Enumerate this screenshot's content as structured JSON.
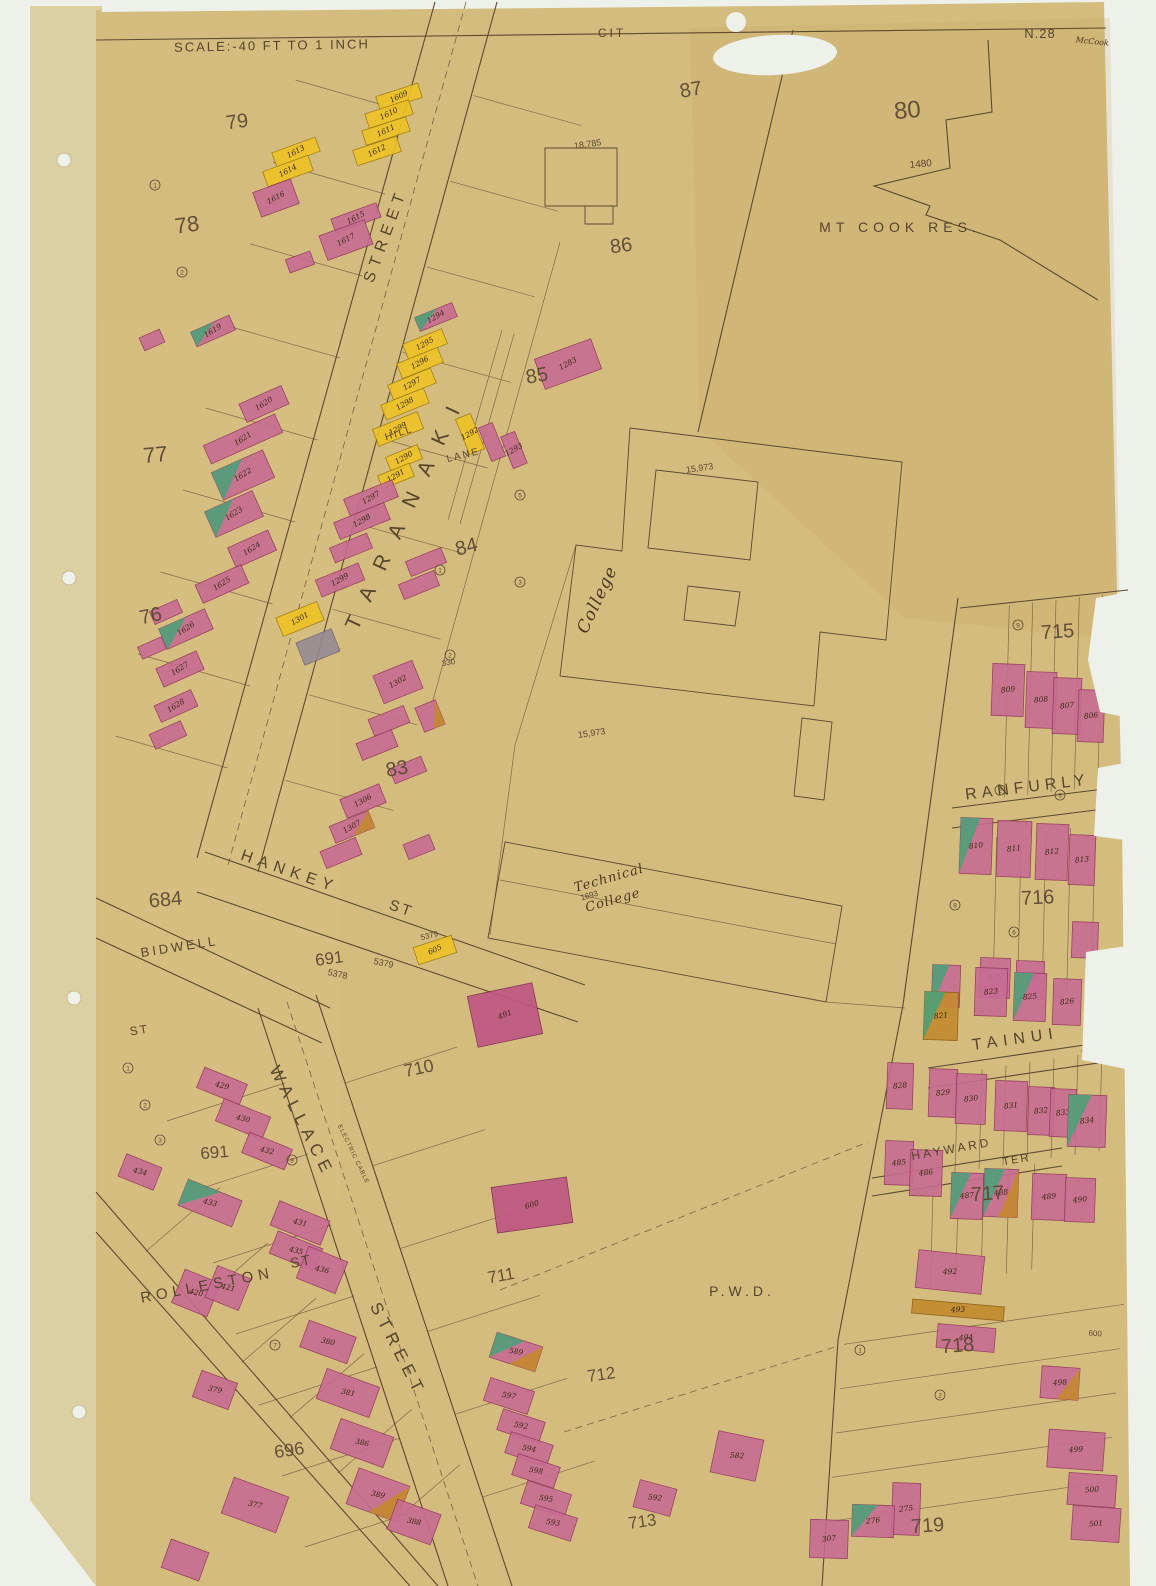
{
  "sheet": {
    "scale_label": "SCALE:-40 FT TO 1 INCH",
    "city_label": "CIT",
    "sheet_number": "N.28",
    "corner_note": "McCook"
  },
  "colors": {
    "scan": "#eef0ea",
    "binding": "#dccfa2",
    "paper": "#d4bc7e",
    "ink": "#5d4a31",
    "text": "#57442c",
    "pink": "#c76d92",
    "pink_deep": "#bf5584",
    "yellow": "#eec226",
    "orange": "#c38a2e",
    "green": "#4f9e78",
    "grey": "#958a94"
  },
  "blocks": [
    {
      "t": "79",
      "x": 238,
      "y": 128,
      "s": 20,
      "r": -8
    },
    {
      "t": "78",
      "x": 188,
      "y": 232,
      "s": 22,
      "r": -8
    },
    {
      "t": "77",
      "x": 156,
      "y": 462,
      "s": 22,
      "r": -5
    },
    {
      "t": "76",
      "x": 152,
      "y": 622,
      "s": 20,
      "r": -12
    },
    {
      "t": "80",
      "x": 908,
      "y": 118,
      "s": 24,
      "r": -5
    },
    {
      "t": "87",
      "x": 692,
      "y": 96,
      "s": 20,
      "r": -10
    },
    {
      "t": "86",
      "x": 622,
      "y": 252,
      "s": 20,
      "r": -8
    },
    {
      "t": "85",
      "x": 538,
      "y": 382,
      "s": 20,
      "r": -10
    },
    {
      "t": "84",
      "x": 468,
      "y": 553,
      "s": 20,
      "r": -15
    },
    {
      "t": "83",
      "x": 398,
      "y": 775,
      "s": 20,
      "r": -10
    },
    {
      "t": "684",
      "x": 166,
      "y": 906,
      "s": 20,
      "r": -5
    },
    {
      "t": "691",
      "x": 330,
      "y": 964,
      "s": 17,
      "r": -8
    },
    {
      "t": "691",
      "x": 215,
      "y": 1158,
      "s": 17,
      "r": -5
    },
    {
      "t": "696",
      "x": 290,
      "y": 1456,
      "s": 18,
      "r": -8
    },
    {
      "t": "710",
      "x": 420,
      "y": 1074,
      "s": 18,
      "r": -12
    },
    {
      "t": "711",
      "x": 502,
      "y": 1281,
      "s": 17,
      "r": -10
    },
    {
      "t": "712",
      "x": 602,
      "y": 1380,
      "s": 17,
      "r": -8
    },
    {
      "t": "713",
      "x": 643,
      "y": 1527,
      "s": 17,
      "r": -8
    },
    {
      "t": "715",
      "x": 1058,
      "y": 638,
      "s": 20,
      "r": -4
    },
    {
      "t": "716",
      "x": 1038,
      "y": 904,
      "s": 20,
      "r": -3
    },
    {
      "t": "717",
      "x": 988,
      "y": 1200,
      "s": 20,
      "r": -4
    },
    {
      "t": "718",
      "x": 958,
      "y": 1352,
      "s": 20,
      "r": -4
    },
    {
      "t": "719",
      "x": 928,
      "y": 1532,
      "s": 20,
      "r": -4
    }
  ],
  "streets": [
    {
      "id": "taranaki",
      "t": "TARANAKI",
      "x": 413,
      "y": 512,
      "r": -65,
      "s": 21,
      "sp": 20
    },
    {
      "id": "taranaki-street",
      "t": "STREET",
      "x": 390,
      "y": 237,
      "r": -70,
      "s": 16,
      "sp": 6
    },
    {
      "id": "hankey",
      "t": "HANKEY",
      "x": 288,
      "y": 876,
      "r": 19,
      "s": 16,
      "sp": 6
    },
    {
      "id": "hankey-st",
      "t": "ST",
      "x": 400,
      "y": 913,
      "r": 19,
      "s": 15,
      "sp": 3
    },
    {
      "id": "bidwell",
      "t": "BIDWELL",
      "x": 180,
      "y": 951,
      "r": -9,
      "s": 13,
      "sp": 3
    },
    {
      "id": "bidwell-st",
      "t": "ST",
      "x": 140,
      "y": 1034,
      "r": -9,
      "s": 12,
      "sp": 2
    },
    {
      "id": "wallace",
      "t": "WALLACE",
      "x": 297,
      "y": 1124,
      "r": 63,
      "s": 17,
      "sp": 6
    },
    {
      "id": "wallace-street",
      "t": "STREET",
      "x": 393,
      "y": 1352,
      "r": 63,
      "s": 17,
      "sp": 6
    },
    {
      "id": "rolleston",
      "t": "ROLLESTON",
      "x": 208,
      "y": 1290,
      "r": -11,
      "s": 15,
      "sp": 5
    },
    {
      "id": "rolleston-st",
      "t": "ST",
      "x": 302,
      "y": 1266,
      "r": -11,
      "s": 14,
      "sp": 2
    },
    {
      "id": "ranfurly",
      "t": "RANFURLY",
      "x": 1028,
      "y": 792,
      "r": -7,
      "s": 16,
      "sp": 5
    },
    {
      "id": "ranfurly-tce",
      "t": "TCE",
      "x": 1110,
      "y": 798,
      "r": -7,
      "s": 11,
      "sp": 1
    },
    {
      "id": "tainui",
      "t": "TAINUI",
      "x": 1016,
      "y": 1044,
      "r": -8,
      "s": 16,
      "sp": 6
    },
    {
      "id": "tainui-ter",
      "t": "TER",
      "x": 1102,
      "y": 1058,
      "r": -8,
      "s": 15,
      "sp": 3
    },
    {
      "id": "hayward",
      "t": "HAYWARD",
      "x": 952,
      "y": 1153,
      "r": -10,
      "s": 12,
      "sp": 3
    },
    {
      "id": "hayward-ter",
      "t": "TER",
      "x": 1017,
      "y": 1163,
      "r": -10,
      "s": 11,
      "sp": 2
    },
    {
      "id": "hill",
      "t": "HILL",
      "x": 400,
      "y": 436,
      "r": -18,
      "s": 10,
      "sp": 2
    },
    {
      "id": "lane",
      "t": "LANE",
      "x": 464,
      "y": 458,
      "r": -14,
      "s": 10,
      "sp": 2
    },
    {
      "id": "electric-cable",
      "t": "ELECTRIC CABLE",
      "x": 352,
      "y": 1155,
      "r": 64,
      "s": 6,
      "sp": 1
    }
  ],
  "landmarks": [
    {
      "id": "mt-cook-res",
      "t": "MT COOK RES.",
      "x": 900,
      "y": 232,
      "r": 0,
      "s": 14,
      "sp": 5,
      "style": "print"
    },
    {
      "id": "college",
      "t": "College",
      "x": 602,
      "y": 602,
      "r": -65,
      "s": 17,
      "sp": 1,
      "style": "script"
    },
    {
      "id": "technical",
      "t": "Technical",
      "x": 610,
      "y": 882,
      "r": -16,
      "s": 13,
      "sp": 1,
      "style": "script"
    },
    {
      "id": "technical-college",
      "t": "College",
      "x": 614,
      "y": 904,
      "r": -16,
      "s": 13,
      "sp": 1,
      "style": "script"
    },
    {
      "id": "pwd",
      "t": "P.W.D.",
      "x": 742,
      "y": 1296,
      "r": 0,
      "s": 14,
      "sp": 4,
      "style": "print"
    }
  ],
  "refs": [
    {
      "t": "1480",
      "x": 921,
      "y": 167,
      "r": -5,
      "s": 10
    },
    {
      "t": "18,785",
      "x": 588,
      "y": 147,
      "r": -8,
      "s": 9
    },
    {
      "t": "15,973",
      "x": 700,
      "y": 471,
      "r": -8,
      "s": 9
    },
    {
      "t": "15,973",
      "x": 592,
      "y": 736,
      "r": -8,
      "s": 9
    },
    {
      "t": "5379",
      "x": 383,
      "y": 966,
      "r": 12,
      "s": 9
    },
    {
      "t": "5378",
      "x": 337,
      "y": 977,
      "r": 12,
      "s": 9
    },
    {
      "t": "5379",
      "x": 430,
      "y": 938,
      "r": -15,
      "s": 8
    },
    {
      "t": "330",
      "x": 449,
      "y": 665,
      "r": -10,
      "s": 8
    },
    {
      "t": "1693",
      "x": 590,
      "y": 898,
      "r": -16,
      "s": 8
    },
    {
      "t": "600",
      "x": 1095,
      "y": 1336,
      "r": 4,
      "s": 8
    }
  ],
  "buildings_format": "[cx, cy, w, h, rotation_deg, color_code(P pink, D deep-pink, Y yellow, O orange, N grey; +G green patch, +O orange patch), label]",
  "buildings": [
    [
      399,
      97,
      44,
      15,
      -18,
      "Y",
      "1609"
    ],
    [
      389,
      114,
      46,
      15,
      -18,
      "Y",
      "1610"
    ],
    [
      386,
      131,
      46,
      15,
      -18,
      "Y",
      "1611"
    ],
    [
      377,
      151,
      46,
      16,
      -18,
      "Y",
      "1612"
    ],
    [
      296,
      152,
      46,
      15,
      -20,
      "Y",
      "1613"
    ],
    [
      288,
      171,
      48,
      16,
      -20,
      "Y",
      "1614"
    ],
    [
      276,
      198,
      40,
      26,
      -20,
      "P",
      "1616"
    ],
    [
      356,
      218,
      48,
      15,
      -20,
      "P",
      "1615"
    ],
    [
      346,
      240,
      48,
      26,
      -20,
      "P",
      "1617"
    ],
    [
      300,
      262,
      26,
      14,
      -20,
      "P",
      ""
    ],
    [
      213,
      331,
      42,
      16,
      -24,
      "PG",
      "1619"
    ],
    [
      152,
      340,
      22,
      14,
      -24,
      "P",
      ""
    ],
    [
      264,
      404,
      46,
      20,
      -24,
      "P",
      "1620"
    ],
    [
      243,
      439,
      78,
      20,
      -24,
      "P",
      "1621"
    ],
    [
      243,
      475,
      56,
      30,
      -24,
      "PG",
      "1622"
    ],
    [
      234,
      514,
      52,
      28,
      -24,
      "PG",
      "1623"
    ],
    [
      252,
      549,
      44,
      22,
      -24,
      "P",
      "1624"
    ],
    [
      222,
      584,
      50,
      20,
      -24,
      "P",
      "1625"
    ],
    [
      186,
      629,
      50,
      22,
      -24,
      "PG",
      "1626"
    ],
    [
      180,
      669,
      44,
      20,
      -24,
      "P",
      "1627"
    ],
    [
      166,
      612,
      30,
      14,
      -24,
      "P",
      ""
    ],
    [
      152,
      648,
      26,
      13,
      -24,
      "P",
      ""
    ],
    [
      176,
      706,
      40,
      18,
      -24,
      "P",
      "1628"
    ],
    [
      168,
      735,
      34,
      16,
      -24,
      "P",
      ""
    ],
    [
      436,
      317,
      40,
      15,
      -22,
      "PG",
      "1294"
    ],
    [
      425,
      344,
      42,
      16,
      -22,
      "Y",
      "1295"
    ],
    [
      420,
      363,
      44,
      16,
      -22,
      "Y",
      "1296"
    ],
    [
      412,
      384,
      46,
      16,
      -22,
      "Y",
      "1297"
    ],
    [
      405,
      404,
      46,
      16,
      -22,
      "Y",
      "1298"
    ],
    [
      398,
      429,
      48,
      18,
      -22,
      "Y",
      "1299"
    ],
    [
      404,
      458,
      34,
      15,
      -22,
      "Y",
      "1290"
    ],
    [
      396,
      476,
      34,
      14,
      -22,
      "Y",
      "1291"
    ],
    [
      568,
      364,
      60,
      32,
      -20,
      "P",
      "1283"
    ],
    [
      470,
      434,
      16,
      38,
      -22,
      "Y",
      "1292"
    ],
    [
      492,
      442,
      15,
      36,
      -22,
      "P",
      ""
    ],
    [
      514,
      450,
      15,
      34,
      -22,
      "P",
      "1293"
    ],
    [
      371,
      498,
      52,
      18,
      -22,
      "P",
      "1297"
    ],
    [
      362,
      521,
      54,
      18,
      -22,
      "P",
      "1298"
    ],
    [
      351,
      548,
      40,
      16,
      -22,
      "P",
      ""
    ],
    [
      340,
      580,
      46,
      18,
      -22,
      "P",
      "1299"
    ],
    [
      426,
      562,
      38,
      16,
      -22,
      "P",
      ""
    ],
    [
      419,
      585,
      38,
      16,
      -22,
      "P",
      ""
    ],
    [
      300,
      619,
      44,
      20,
      -22,
      "Y",
      "1301"
    ],
    [
      318,
      647,
      38,
      24,
      -22,
      "N",
      ""
    ],
    [
      398,
      682,
      42,
      30,
      -22,
      "P",
      "1302"
    ],
    [
      389,
      721,
      38,
      18,
      -22,
      "P",
      ""
    ],
    [
      377,
      745,
      38,
      18,
      -22,
      "P",
      ""
    ],
    [
      430,
      716,
      22,
      26,
      -22,
      "PO",
      ""
    ],
    [
      363,
      801,
      42,
      20,
      -22,
      "P",
      "1306"
    ],
    [
      352,
      827,
      42,
      18,
      -22,
      "PO",
      "1307"
    ],
    [
      341,
      853,
      38,
      18,
      -22,
      "P",
      ""
    ],
    [
      419,
      847,
      28,
      16,
      -22,
      "P",
      ""
    ],
    [
      408,
      770,
      34,
      16,
      -22,
      "P",
      ""
    ],
    [
      435,
      950,
      40,
      18,
      -18,
      "Y",
      "605"
    ],
    [
      505,
      1015,
      66,
      52,
      -12,
      "D",
      "491"
    ],
    [
      532,
      1205,
      76,
      46,
      -8,
      "D",
      "600"
    ],
    [
      222,
      1086,
      46,
      22,
      22,
      "P",
      "429"
    ],
    [
      243,
      1119,
      50,
      24,
      22,
      "P",
      "430"
    ],
    [
      267,
      1151,
      46,
      22,
      22,
      "P",
      "432"
    ],
    [
      140,
      1172,
      38,
      24,
      22,
      "P",
      "434"
    ],
    [
      210,
      1203,
      58,
      28,
      22,
      "PG",
      "433"
    ],
    [
      300,
      1223,
      54,
      26,
      22,
      "P",
      "431"
    ],
    [
      296,
      1251,
      48,
      24,
      22,
      "P",
      "435"
    ],
    [
      322,
      1270,
      42,
      34,
      22,
      "P",
      "436"
    ],
    [
      196,
      1293,
      38,
      36,
      22,
      "P",
      "420"
    ],
    [
      228,
      1288,
      36,
      34,
      22,
      "P",
      "421"
    ],
    [
      215,
      1390,
      38,
      28,
      20,
      "P",
      "379"
    ],
    [
      328,
      1342,
      50,
      28,
      20,
      "P",
      "380"
    ],
    [
      348,
      1393,
      56,
      32,
      20,
      "P",
      "381"
    ],
    [
      362,
      1443,
      56,
      32,
      20,
      "P",
      "386"
    ],
    [
      255,
      1505,
      58,
      38,
      20,
      "P",
      "377"
    ],
    [
      378,
      1495,
      54,
      38,
      20,
      "PO",
      "389"
    ],
    [
      414,
      1522,
      46,
      32,
      20,
      "P",
      "388"
    ],
    [
      185,
      1560,
      40,
      30,
      20,
      "P",
      ""
    ],
    [
      516,
      1352,
      48,
      26,
      18,
      "PGO",
      "589"
    ],
    [
      509,
      1396,
      46,
      24,
      18,
      "P",
      "597"
    ],
    [
      521,
      1426,
      44,
      22,
      18,
      "P",
      "592"
    ],
    [
      529,
      1449,
      44,
      22,
      18,
      "P",
      "594"
    ],
    [
      536,
      1471,
      44,
      22,
      18,
      "P",
      "598"
    ],
    [
      546,
      1499,
      46,
      24,
      18,
      "P",
      "595"
    ],
    [
      553,
      1523,
      44,
      24,
      18,
      "P",
      "593"
    ],
    [
      655,
      1498,
      38,
      28,
      15,
      "P",
      "592"
    ],
    [
      737,
      1456,
      46,
      42,
      12,
      "P",
      "582"
    ],
    [
      950,
      1272,
      66,
      38,
      6,
      "P",
      "492"
    ],
    [
      958,
      1310,
      92,
      14,
      5,
      "O",
      "493"
    ],
    [
      966,
      1338,
      58,
      24,
      5,
      "P",
      "494"
    ],
    [
      1060,
      1383,
      38,
      32,
      4,
      "PO",
      "498"
    ],
    [
      1076,
      1450,
      56,
      38,
      4,
      "P",
      "499"
    ],
    [
      1092,
      1490,
      48,
      32,
      4,
      "P",
      "500"
    ],
    [
      1096,
      1524,
      48,
      34,
      4,
      "P",
      "501"
    ],
    [
      906,
      1509,
      28,
      52,
      2,
      "P",
      "275"
    ],
    [
      873,
      1521,
      42,
      32,
      2,
      "PG",
      "276"
    ],
    [
      829,
      1539,
      38,
      38,
      2,
      "P",
      "307"
    ],
    [
      1008,
      690,
      32,
      52,
      2,
      "P",
      "809"
    ],
    [
      1041,
      700,
      30,
      56,
      2,
      "P",
      "808"
    ],
    [
      1067,
      706,
      28,
      56,
      2,
      "P",
      "807"
    ],
    [
      1091,
      716,
      26,
      52,
      2,
      "P",
      "806"
    ],
    [
      976,
      846,
      32,
      56,
      2,
      "PG",
      "810"
    ],
    [
      1014,
      849,
      34,
      56,
      2,
      "P",
      "811"
    ],
    [
      1052,
      852,
      32,
      56,
      2,
      "P",
      "812"
    ],
    [
      1082,
      860,
      26,
      50,
      2,
      "P",
      "813"
    ],
    [
      946,
      986,
      28,
      42,
      2,
      "PG",
      ""
    ],
    [
      995,
      978,
      30,
      40,
      2,
      "P",
      "815"
    ],
    [
      1030,
      980,
      28,
      38,
      2,
      "P",
      "816"
    ],
    [
      1085,
      940,
      26,
      36,
      2,
      "P",
      ""
    ],
    [
      991,
      992,
      32,
      48,
      2,
      "P",
      "823"
    ],
    [
      1030,
      997,
      32,
      48,
      2,
      "PG",
      "825"
    ],
    [
      1067,
      1002,
      28,
      46,
      2,
      "P",
      "826"
    ],
    [
      941,
      1016,
      34,
      48,
      2,
      "OG",
      "821"
    ],
    [
      900,
      1086,
      26,
      46,
      2,
      "P",
      "828"
    ],
    [
      943,
      1093,
      28,
      48,
      2,
      "P",
      "829"
    ],
    [
      971,
      1099,
      30,
      50,
      2,
      "P",
      "830"
    ],
    [
      1011,
      1106,
      32,
      50,
      2,
      "P",
      "831"
    ],
    [
      1041,
      1111,
      26,
      48,
      2,
      "P",
      "832"
    ],
    [
      1063,
      1113,
      26,
      48,
      2,
      "P",
      "833"
    ],
    [
      1087,
      1121,
      38,
      52,
      2,
      "PG",
      "834"
    ],
    [
      899,
      1163,
      28,
      44,
      2,
      "P",
      "485"
    ],
    [
      926,
      1173,
      32,
      46,
      2,
      "P",
      "486"
    ],
    [
      967,
      1196,
      32,
      46,
      2,
      "PG",
      "487"
    ],
    [
      1001,
      1193,
      34,
      48,
      2,
      "PGO",
      "488"
    ],
    [
      1049,
      1197,
      34,
      46,
      2,
      "P",
      "489"
    ],
    [
      1080,
      1200,
      30,
      44,
      2,
      "P",
      "490"
    ]
  ],
  "lot_circles": [
    {
      "n": "9",
      "x": 1018,
      "y": 625
    },
    {
      "n": "2",
      "x": 1000,
      "y": 790
    },
    {
      "n": "3",
      "x": 1060,
      "y": 795
    },
    {
      "n": "8",
      "x": 955,
      "y": 905
    },
    {
      "n": "6",
      "x": 1014,
      "y": 932
    },
    {
      "n": "1",
      "x": 440,
      "y": 570
    },
    {
      "n": "2",
      "x": 450,
      "y": 655
    },
    {
      "n": "5",
      "x": 520,
      "y": 495
    },
    {
      "n": "3",
      "x": 520,
      "y": 582
    },
    {
      "n": "1",
      "x": 155,
      "y": 185
    },
    {
      "n": "2",
      "x": 182,
      "y": 272
    },
    {
      "n": "7",
      "x": 275,
      "y": 1345
    },
    {
      "n": "8",
      "x": 292,
      "y": 1160
    },
    {
      "n": "1",
      "x": 128,
      "y": 1068
    },
    {
      "n": "2",
      "x": 145,
      "y": 1105
    },
    {
      "n": "3",
      "x": 160,
      "y": 1140
    },
    {
      "n": "1",
      "x": 860,
      "y": 1350
    },
    {
      "n": "2",
      "x": 940,
      "y": 1395
    }
  ]
}
